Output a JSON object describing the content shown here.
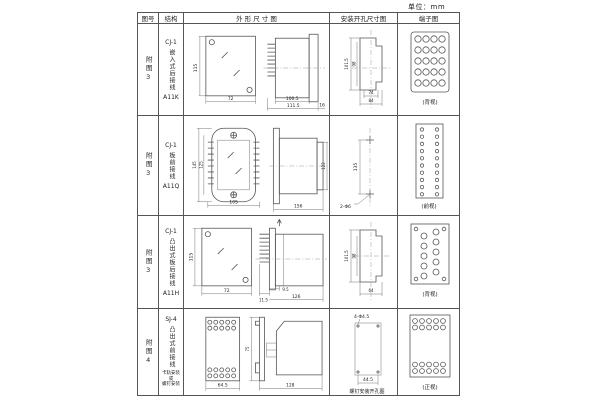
{
  "page": {
    "unit_label": "单位：mm"
  },
  "table": {
    "headers": {
      "fig_no": "图号",
      "structure": "结构",
      "outline": "外 形 尺 寸 图",
      "mounting": "安装开孔尺寸图",
      "terminal": "端子图"
    },
    "rows": [
      {
        "fig_no": "附图3",
        "model": "CJ-1",
        "structure": "嵌入式后接线",
        "socket": "A11K",
        "outline": {
          "front_h": "115",
          "front_w": "72",
          "side_w1": "100.5",
          "side_w2": "111.5",
          "side_d": "16"
        },
        "mounting": {
          "v_outer": "101.5",
          "v_inner": "98",
          "h_inner": "74",
          "h_outer": "84"
        },
        "terminal": {
          "label": "(背视)",
          "count": 20
        }
      },
      {
        "fig_no": "附图3",
        "model": "CJ-1",
        "structure": "板前接线",
        "socket": "A11Q",
        "outline": {
          "front_h_outer": "145",
          "front_h_inner": "125",
          "front_w": "105",
          "side_w": "156",
          "side_h": "122"
        },
        "mounting": {
          "v": "135",
          "holes": "2-Φ6"
        },
        "terminal": {
          "label": "(前视)",
          "count": 20
        }
      },
      {
        "fig_no": "附图3",
        "model": "CJ-1",
        "structure": "凸出式板后接线",
        "socket": "A11H",
        "outline": {
          "front_h": "115",
          "front_w": "72",
          "side_d1": "11.5",
          "side_d2": "9.5",
          "side_w": "126"
        },
        "mounting": {
          "v_outer": "101.5",
          "v_inner": "98",
          "h": "64"
        },
        "terminal": {
          "label": "(背视)",
          "count": 14
        }
      },
      {
        "fig_no": "附图4",
        "model": "SJ-4",
        "structure": "凸出式前接线",
        "note_lines": [
          "卡轨安装",
          "或",
          "螺钉安装"
        ],
        "outline": {
          "front_w": "64.5",
          "side_h": "75",
          "side_w": "128"
        },
        "mounting": {
          "holes": "4-Φ4.5",
          "w": "44.5",
          "caption": "螺钉安装开孔图"
        },
        "terminal": {
          "label": "(正视)",
          "count": 20
        }
      }
    ]
  }
}
